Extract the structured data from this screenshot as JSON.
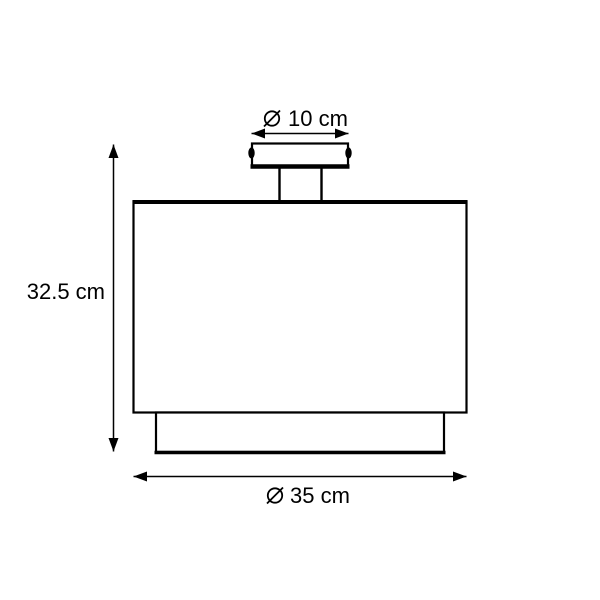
{
  "diagram": {
    "colors": {
      "line": "#000000",
      "background": "#ffffff"
    },
    "dimensions": {
      "canopy_diameter": {
        "symbol": "⌀",
        "label": "10 cm"
      },
      "height": {
        "label": "32.5 cm"
      },
      "shade_diameter": {
        "symbol": "⌀",
        "label": "35 cm"
      }
    }
  }
}
